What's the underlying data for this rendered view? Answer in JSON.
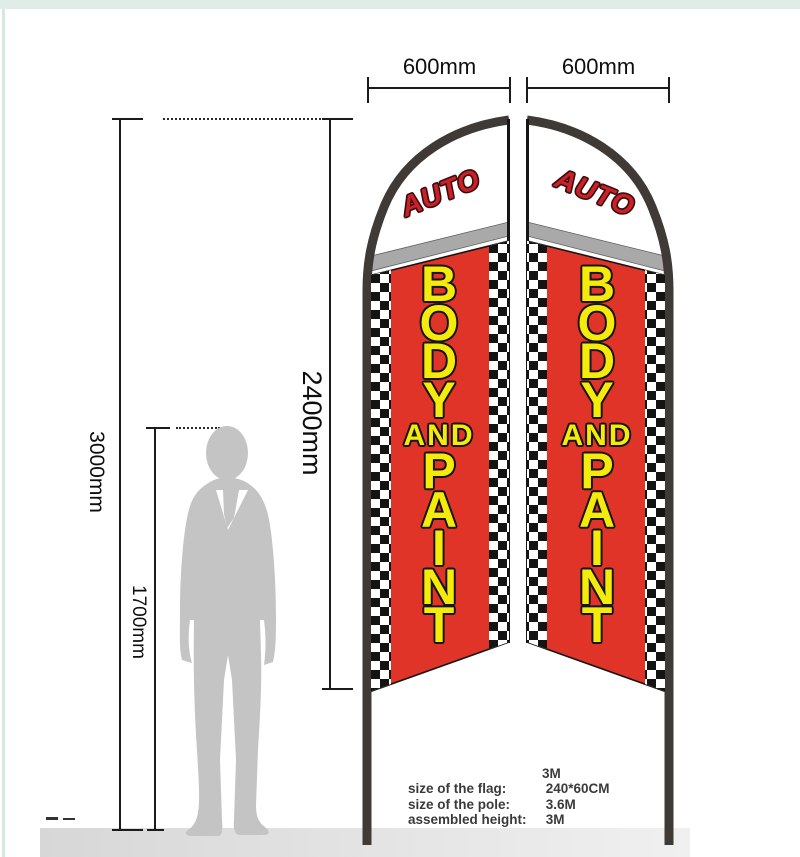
{
  "dimensions": {
    "left_flag_width": "600mm",
    "right_flag_width": "600mm",
    "assembled_height": "3000mm",
    "flag_length": "2400mm",
    "person_height": "1700mm"
  },
  "flag": {
    "auto": "AUTO",
    "word_top": [
      "B",
      "O",
      "D",
      "Y"
    ],
    "word_mid": "AND",
    "word_bottom": [
      "P",
      "A",
      "I",
      "N",
      "T"
    ]
  },
  "specs": {
    "pole_header": "3M",
    "rows": [
      {
        "label": "size of the flag:",
        "value": "240*60CM"
      },
      {
        "label": "size of the pole:",
        "value": "3.6M"
      },
      {
        "label": "assembled height:",
        "value": "3M"
      }
    ]
  },
  "colors": {
    "flag_red": "#e03428",
    "auto_red": "#ca2028",
    "letter_yellow": "#f4eb0b",
    "band_gray": "#a9a9a9",
    "pole_gray": "#403a36",
    "checker_black": "#141414",
    "person_gray": "#c4c4c4",
    "frame_green": "#dfede6",
    "floor_gray": "#d7d7d7"
  }
}
